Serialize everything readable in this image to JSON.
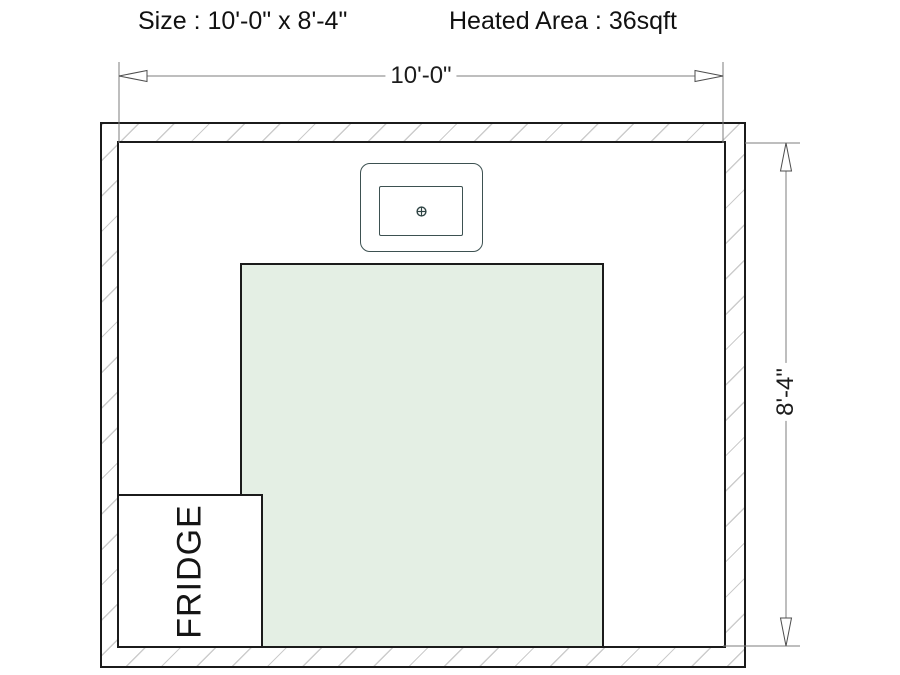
{
  "header": {
    "size_label": "Size : 10'-0\" x 8'-4\"",
    "heated_area_label": "Heated Area : 36sqft"
  },
  "dimensions": {
    "width": "10'-0\"",
    "height": "8'-4\""
  },
  "room": {
    "fridge_label": "FRIDGE"
  },
  "icons": {
    "sink_drain_icon": "circle-crosshair-drain",
    "arrowheads": "open-triangle"
  },
  "colors": {
    "heated_area_fill": "#e4efe4",
    "wall_line": "#1b1b1b",
    "hatch_line": "#cccccc",
    "dimension_line": "#7d7d7d",
    "sink_outline": "#3d5151",
    "text": "#111111"
  }
}
